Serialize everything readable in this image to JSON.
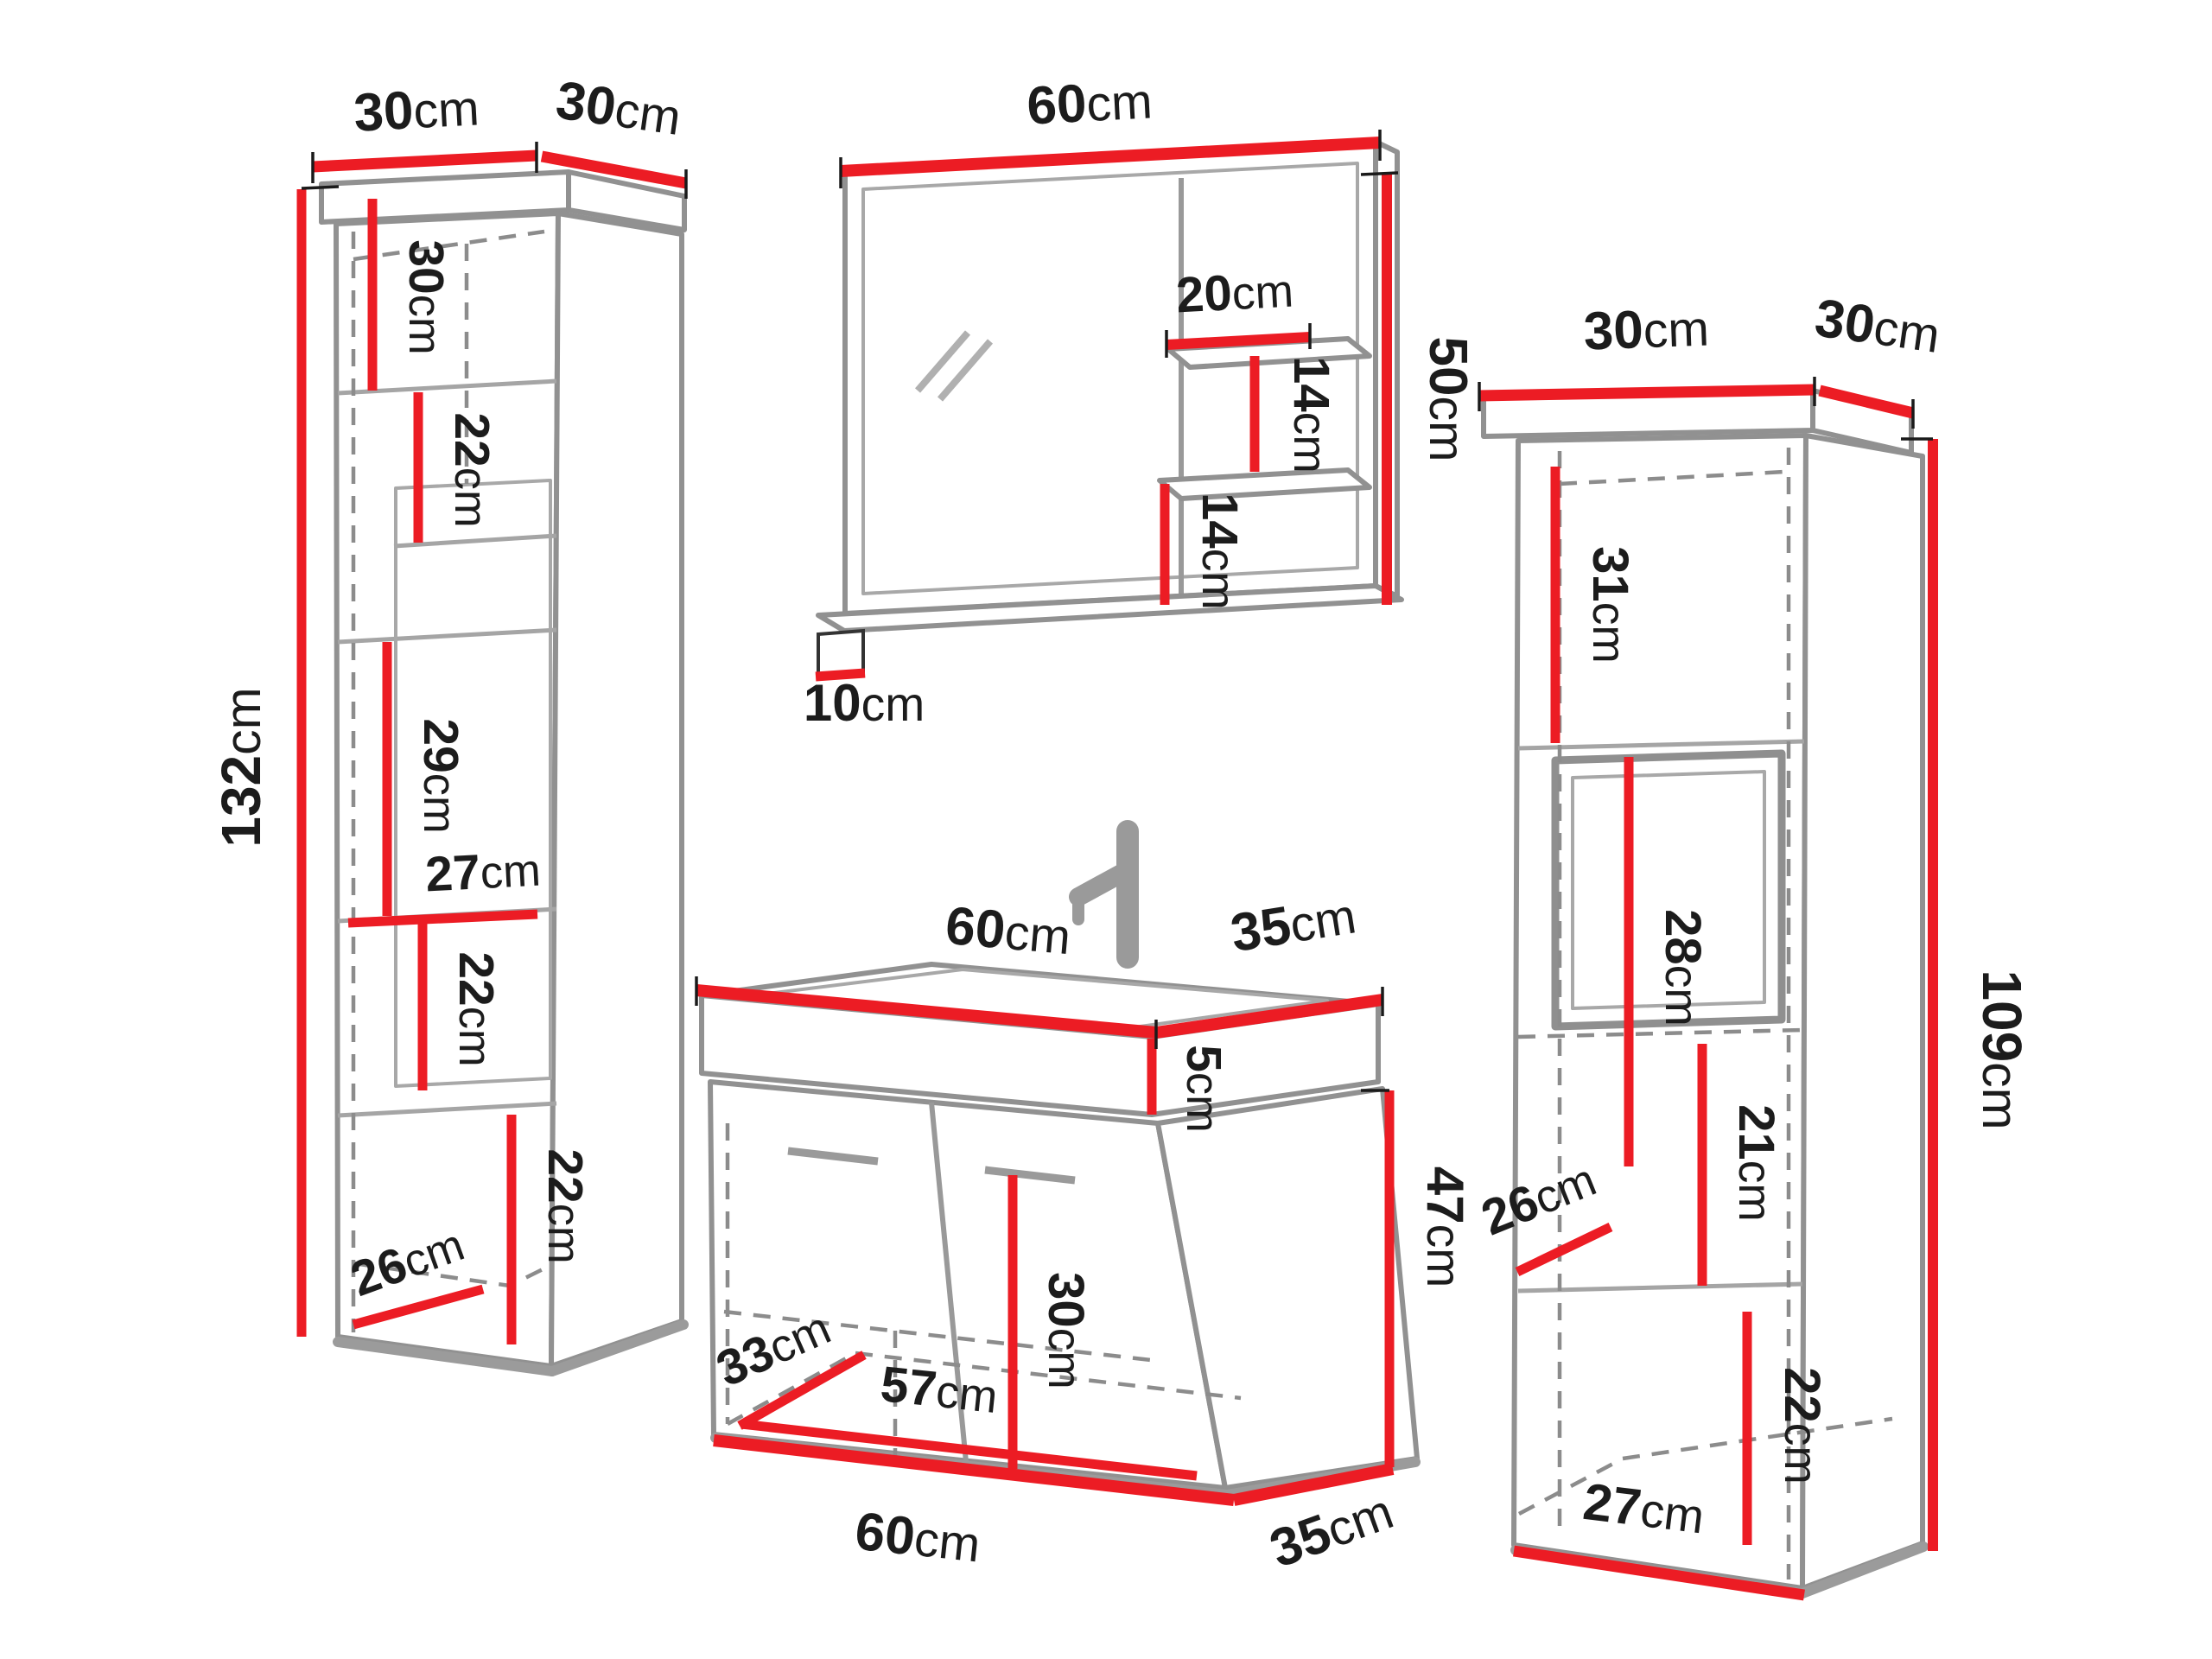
{
  "diagram_title": "bathroom-furniture-set-dimensions",
  "colors": {
    "dimension_red": "#ec1c24",
    "outline_gray": "#919191",
    "text_black": "#1c1c1c",
    "background": "#ffffff"
  },
  "left_cabinet": {
    "top_width": {
      "v": "30",
      "u": "cm"
    },
    "top_depth": {
      "v": "30",
      "u": "cm"
    },
    "height": {
      "v": "132",
      "u": "cm"
    },
    "compartment_1": {
      "v": "30",
      "u": "cm"
    },
    "compartment_2": {
      "v": "22",
      "u": "cm"
    },
    "compartment_3": {
      "v": "29",
      "u": "cm"
    },
    "inner_width": {
      "v": "27",
      "u": "cm"
    },
    "compartment_4": {
      "v": "22",
      "u": "cm"
    },
    "compartment_5": {
      "v": "22",
      "u": "cm"
    },
    "inner_depth": {
      "v": "26",
      "u": "cm"
    }
  },
  "mirror": {
    "top_width": {
      "v": "60",
      "u": "cm"
    },
    "height": {
      "v": "50",
      "u": "cm"
    },
    "shelf_width": {
      "v": "20",
      "u": "cm"
    },
    "shelf_gap_upper": {
      "v": "14",
      "u": "cm"
    },
    "shelf_gap_lower": {
      "v": "14",
      "u": "cm"
    },
    "bottom_shelf_depth": {
      "v": "10",
      "u": "cm"
    }
  },
  "sink_cabinet": {
    "top_width": {
      "v": "60",
      "u": "cm"
    },
    "top_depth": {
      "v": "35",
      "u": "cm"
    },
    "basin_height": {
      "v": "5",
      "u": "cm"
    },
    "body_height": {
      "v": "47",
      "u": "cm"
    },
    "inner_height": {
      "v": "30",
      "u": "cm"
    },
    "inner_depth": {
      "v": "33",
      "u": "cm"
    },
    "inner_width": {
      "v": "57",
      "u": "cm"
    },
    "bottom_width": {
      "v": "60",
      "u": "cm"
    },
    "bottom_depth": {
      "v": "35",
      "u": "cm"
    }
  },
  "right_cabinet": {
    "top_width": {
      "v": "30",
      "u": "cm"
    },
    "top_depth": {
      "v": "30",
      "u": "cm"
    },
    "height": {
      "v": "109",
      "u": "cm"
    },
    "compartment_1": {
      "v": "31",
      "u": "cm"
    },
    "compartment_2": {
      "v": "28",
      "u": "cm"
    },
    "compartment_3": {
      "v": "21",
      "u": "cm"
    },
    "inner_depth": {
      "v": "26",
      "u": "cm"
    },
    "compartment_4": {
      "v": "22",
      "u": "cm"
    },
    "bottom_width": {
      "v": "27",
      "u": "cm"
    }
  }
}
